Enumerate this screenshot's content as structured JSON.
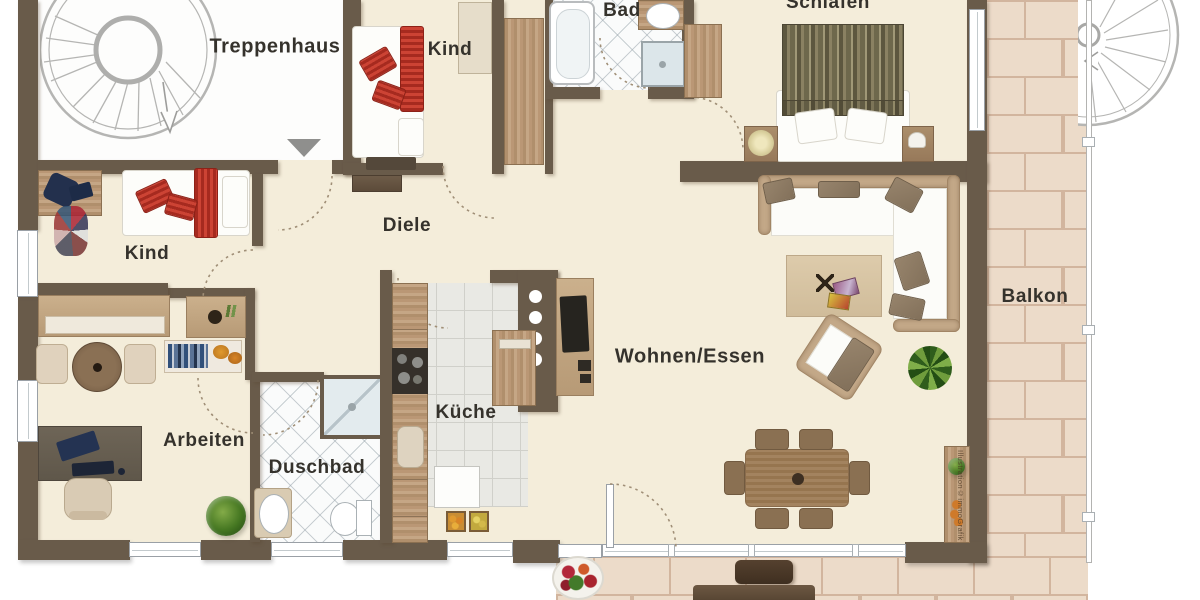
{
  "rooms": {
    "treppenhaus": "Treppenhaus",
    "kind_top": "Kind",
    "bad": "Bad",
    "schlafen": "Schlafen",
    "diele": "Diele",
    "kind_left": "Kind",
    "wohnen_essen": "Wohnen/Essen",
    "kueche": "Küche",
    "arbeiten": "Arbeiten",
    "duschbad": "Duschbad",
    "balkon": "Balkon"
  },
  "watermark": "Illustration©immoGrafik",
  "colors": {
    "wall": "#695b4a",
    "apartment_floor": "#f4edda",
    "balcony_tile": "#ecdbc9",
    "balcony_grout": "#d2b59e",
    "kitchen_tile": "#e9e9e4",
    "accent_red": "#c0392b",
    "wood_light": "#c5a685",
    "wood_dark": "#5c4b3a",
    "label_text": "#35322c"
  }
}
